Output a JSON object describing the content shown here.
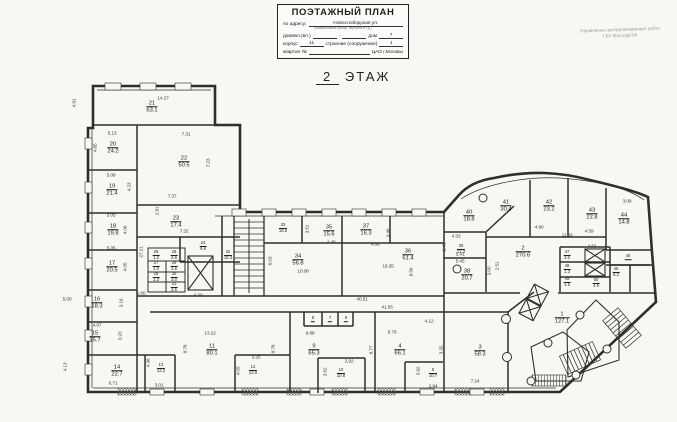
{
  "header": {
    "title_block": {
      "title": "ПОЭТАЖНЫЙ ПЛАН",
      "address_label": "по адресу:",
      "address_value": "Новослободская ул.",
      "address_note": "(наименование улицы, переулка и т.д.)",
      "line2_label": "домовл.(вл.)",
      "line2_dash": "-",
      "line2_house_label": "дом",
      "line2_house_value": "7",
      "line3_korpus_label": "корпус",
      "line3_korpus_value": "11",
      "line3_stroenie_label": "строение (сооружение)",
      "line3_stroenie_value": "1",
      "line4_kvartal_label": "квартал №",
      "line4_right": "ЦАО г.Москвы"
    },
    "agency_line1": "Управление централизованных работ",
    "agency_line2": "ГБУ МосгорБТИ",
    "floor_number": "2",
    "floor_word": "ЭТАЖ"
  },
  "colors": {
    "wall": "#2f2f2d",
    "paper": "#f7f7f4"
  },
  "plan": {
    "rooms": [
      {
        "num": "1",
        "area": "127.1",
        "x": 562,
        "y": 318
      },
      {
        "num": "2",
        "area": "270.6",
        "x": 523,
        "y": 252
      },
      {
        "num": "3",
        "area": "58.3",
        "x": 480,
        "y": 351
      },
      {
        "num": "4",
        "area": "66.1",
        "x": 400,
        "y": 350
      },
      {
        "num": "5",
        "area": "10.7",
        "x": 433,
        "y": 373,
        "s": 1
      },
      {
        "num": "6",
        "area": "",
        "x": 346,
        "y": 319,
        "s": 1
      },
      {
        "num": "7",
        "area": "",
        "x": 330,
        "y": 319,
        "s": 1
      },
      {
        "num": "8",
        "area": "",
        "x": 313,
        "y": 319,
        "s": 1
      },
      {
        "num": "9",
        "area": "65.3",
        "x": 314,
        "y": 350
      },
      {
        "num": "10",
        "area": "10.8",
        "x": 341,
        "y": 373,
        "s": 1
      },
      {
        "num": "11",
        "area": "80.1",
        "x": 212,
        "y": 350
      },
      {
        "num": "12",
        "area": "13.0",
        "x": 253,
        "y": 370,
        "s": 1
      },
      {
        "num": "13",
        "area": "12.2",
        "x": 161,
        "y": 368,
        "s": 1
      },
      {
        "num": "14",
        "area": "22.7",
        "x": 117,
        "y": 371
      },
      {
        "num": "15",
        "area": "15.7",
        "x": 95,
        "y": 337
      },
      {
        "num": "16",
        "area": "18.3",
        "x": 97,
        "y": 303
      },
      {
        "num": "17",
        "area": "20.5",
        "x": 112,
        "y": 267
      },
      {
        "num": "18",
        "area": "19.8",
        "x": 113,
        "y": 230
      },
      {
        "num": "19",
        "area": "21.4",
        "x": 112,
        "y": 190
      },
      {
        "num": "20",
        "area": "24.2",
        "x": 113,
        "y": 148
      },
      {
        "num": "21",
        "area": "63.1",
        "x": 152,
        "y": 107
      },
      {
        "num": "22",
        "area": "50.5",
        "x": 184,
        "y": 162
      },
      {
        "num": "23",
        "area": "17.4",
        "x": 176,
        "y": 222
      },
      {
        "num": "24",
        "area": "9.9",
        "x": 203,
        "y": 246,
        "s": 1
      },
      {
        "num": "25",
        "area": "1.2",
        "x": 156,
        "y": 255,
        "s": 1
      },
      {
        "num": "26",
        "area": "2.6",
        "x": 174,
        "y": 255,
        "s": 1
      },
      {
        "num": "27",
        "area": "1.0",
        "x": 156,
        "y": 266,
        "s": 1
      },
      {
        "num": "28",
        "area": "1.3",
        "x": 156,
        "y": 277,
        "s": 1
      },
      {
        "num": "29",
        "area": "2.6",
        "x": 174,
        "y": 266,
        "s": 1
      },
      {
        "num": "30",
        "area": "3.0",
        "x": 174,
        "y": 277,
        "s": 1
      },
      {
        "num": "31",
        "area": "2.5",
        "x": 174,
        "y": 287,
        "s": 1
      },
      {
        "num": "32",
        "area": "18.3",
        "x": 228,
        "y": 255,
        "s": 1
      },
      {
        "num": "33",
        "area": "16.0",
        "x": 283,
        "y": 228,
        "s": 1
      },
      {
        "num": "34",
        "area": "56.8",
        "x": 298,
        "y": 260
      },
      {
        "num": "35",
        "area": "15.6",
        "x": 329,
        "y": 231
      },
      {
        "num": "36",
        "area": "61.4",
        "x": 408,
        "y": 255
      },
      {
        "num": "37",
        "area": "16.3",
        "x": 366,
        "y": 230
      },
      {
        "num": "38",
        "area": "20.7",
        "x": 467,
        "y": 275
      },
      {
        "num": "39",
        "area": "12.3",
        "x": 461,
        "y": 249,
        "s": 1
      },
      {
        "num": "40",
        "area": "18.8",
        "x": 469,
        "y": 216
      },
      {
        "num": "41",
        "area": "30.4",
        "x": 506,
        "y": 206
      },
      {
        "num": "42",
        "area": "23.2",
        "x": 549,
        "y": 206
      },
      {
        "num": "43",
        "area": "22.8",
        "x": 592,
        "y": 214
      },
      {
        "num": "44",
        "area": "14.8",
        "x": 624,
        "y": 219
      },
      {
        "num": "45",
        "area": "",
        "x": 628,
        "y": 257,
        "s": 1
      },
      {
        "num": "46",
        "area": "6.2",
        "x": 616,
        "y": 272,
        "s": 1
      },
      {
        "num": "47",
        "area": "2.0",
        "x": 567,
        "y": 255,
        "s": 1
      },
      {
        "num": "48",
        "area": "1.3",
        "x": 567,
        "y": 269,
        "s": 1
      },
      {
        "num": "49",
        "area": "1.5",
        "x": 567,
        "y": 282,
        "s": 1
      },
      {
        "num": "50",
        "area": "4.9",
        "x": 596,
        "y": 283,
        "s": 1
      }
    ],
    "dims": [
      {
        "t": "14.27",
        "x": 163,
        "y": 99
      },
      {
        "t": "4.91",
        "x": 75,
        "y": 103,
        "r": 1
      },
      {
        "t": "5.13",
        "x": 112,
        "y": 134
      },
      {
        "t": "4.85",
        "x": 96,
        "y": 148,
        "r": 1
      },
      {
        "t": "7.31",
        "x": 186,
        "y": 135
      },
      {
        "t": "7.23",
        "x": 209,
        "y": 163,
        "r": 1
      },
      {
        "t": "5.08",
        "x": 111,
        "y": 176
      },
      {
        "t": "4.23",
        "x": 130,
        "y": 187,
        "r": 1
      },
      {
        "t": "5.05",
        "x": 111,
        "y": 216
      },
      {
        "t": "4.06",
        "x": 126,
        "y": 230,
        "r": 1
      },
      {
        "t": "5.05",
        "x": 111,
        "y": 249
      },
      {
        "t": "4.05",
        "x": 126,
        "y": 267,
        "r": 1
      },
      {
        "t": "7.37",
        "x": 172,
        "y": 197
      },
      {
        "t": "2.91",
        "x": 158,
        "y": 211,
        "r": 1
      },
      {
        "t": "7.32",
        "x": 184,
        "y": 232
      },
      {
        "t": "27.21",
        "x": 142,
        "y": 252,
        "r": 1
      },
      {
        "t": "1.60",
        "x": 141,
        "y": 294
      },
      {
        "t": "4.20",
        "x": 198,
        "y": 296
      },
      {
        "t": "5.00",
        "x": 67,
        "y": 300
      },
      {
        "t": "3.16",
        "x": 122,
        "y": 303,
        "r": 1
      },
      {
        "t": "4.97",
        "x": 97,
        "y": 326
      },
      {
        "t": "3.23",
        "x": 121,
        "y": 336,
        "r": 1
      },
      {
        "t": "4.13",
        "x": 66,
        "y": 367,
        "r": 1
      },
      {
        "t": "6.71",
        "x": 113,
        "y": 384
      },
      {
        "t": "4.38",
        "x": 149,
        "y": 363,
        "r": 1
      },
      {
        "t": "3.01",
        "x": 159,
        "y": 386
      },
      {
        "t": "13.22",
        "x": 210,
        "y": 334
      },
      {
        "t": "8.76",
        "x": 186,
        "y": 349,
        "r": 1
      },
      {
        "t": "8.76",
        "x": 274,
        "y": 349,
        "r": 1
      },
      {
        "t": "3.25",
        "x": 256,
        "y": 358
      },
      {
        "t": "4.09",
        "x": 239,
        "y": 371,
        "r": 1
      },
      {
        "t": "9.88",
        "x": 310,
        "y": 334
      },
      {
        "t": "2.92",
        "x": 349,
        "y": 362
      },
      {
        "t": "3.62",
        "x": 326,
        "y": 372,
        "r": 1
      },
      {
        "t": "40.51",
        "x": 362,
        "y": 300
      },
      {
        "t": "41.55",
        "x": 387,
        "y": 308
      },
      {
        "t": "9.76",
        "x": 392,
        "y": 333
      },
      {
        "t": "4.12",
        "x": 429,
        "y": 322
      },
      {
        "t": "8.77",
        "x": 372,
        "y": 350,
        "r": 1
      },
      {
        "t": "3.62",
        "x": 419,
        "y": 371,
        "r": 1
      },
      {
        "t": "2.94",
        "x": 433,
        "y": 387
      },
      {
        "t": "3.32",
        "x": 442,
        "y": 350,
        "r": 1
      },
      {
        "t": "7.24",
        "x": 475,
        "y": 382
      },
      {
        "t": "6.03",
        "x": 271,
        "y": 261,
        "r": 1
      },
      {
        "t": "10.08",
        "x": 303,
        "y": 272
      },
      {
        "t": "3.51",
        "x": 308,
        "y": 229,
        "r": 1
      },
      {
        "t": "4.49",
        "x": 331,
        "y": 243
      },
      {
        "t": "4.86",
        "x": 375,
        "y": 245
      },
      {
        "t": "3.46",
        "x": 389,
        "y": 233,
        "r": 1
      },
      {
        "t": "16.35",
        "x": 388,
        "y": 267
      },
      {
        "t": "8.56",
        "x": 412,
        "y": 272,
        "r": 1
      },
      {
        "t": "4.33",
        "x": 456,
        "y": 237
      },
      {
        "t": "2.40",
        "x": 445,
        "y": 247,
        "r": 1
      },
      {
        "t": "5.41",
        "x": 460,
        "y": 255
      },
      {
        "t": "5.45",
        "x": 460,
        "y": 262
      },
      {
        "t": "3.00",
        "x": 490,
        "y": 271,
        "r": 1
      },
      {
        "t": "2.51",
        "x": 498,
        "y": 266,
        "r": 1
      },
      {
        "t": "4.90",
        "x": 539,
        "y": 228
      },
      {
        "t": "11.59",
        "x": 567,
        "y": 236
      },
      {
        "t": "4.59",
        "x": 589,
        "y": 232
      },
      {
        "t": "3.08",
        "x": 627,
        "y": 202
      },
      {
        "t": "4.64",
        "x": 592,
        "y": 247
      }
    ]
  }
}
